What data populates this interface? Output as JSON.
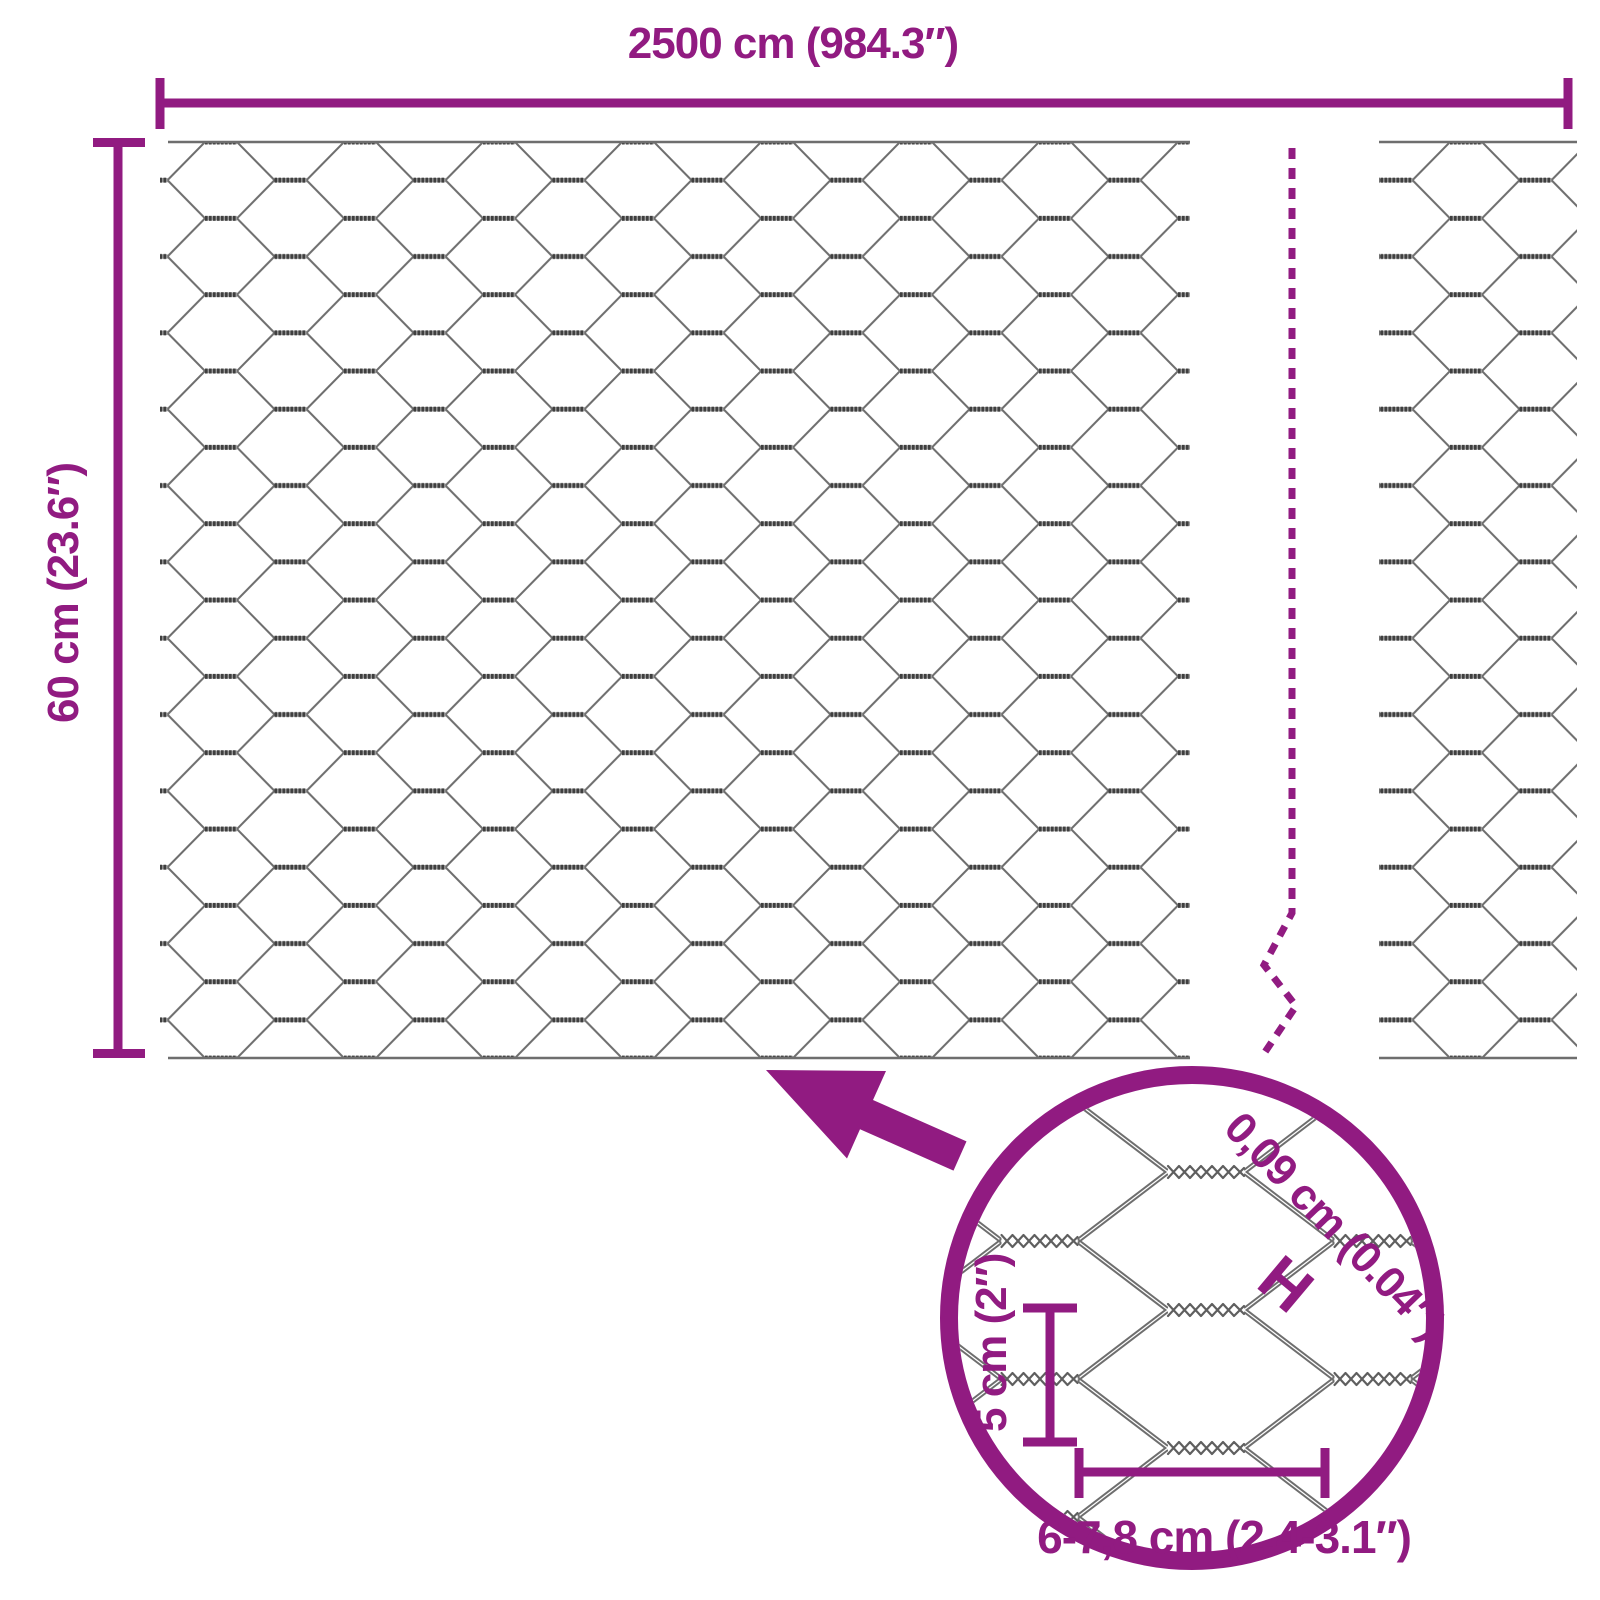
{
  "labels": {
    "total_width": "2500 cm (984.3″)",
    "roll_height": "60 cm (23.6″)",
    "wire_thickness": "0,09 cm (0.04″)",
    "wire_thickness_marker": "H",
    "mesh_cell_height": "5 cm (2″)",
    "mesh_cell_width": "6-7,8 cm (2.4-3.1″)"
  },
  "colors": {
    "accent": "#911b81",
    "wire": "#6e6e6e",
    "wire-dark": "#3f3f3f",
    "bg": "#ffffff"
  }
}
